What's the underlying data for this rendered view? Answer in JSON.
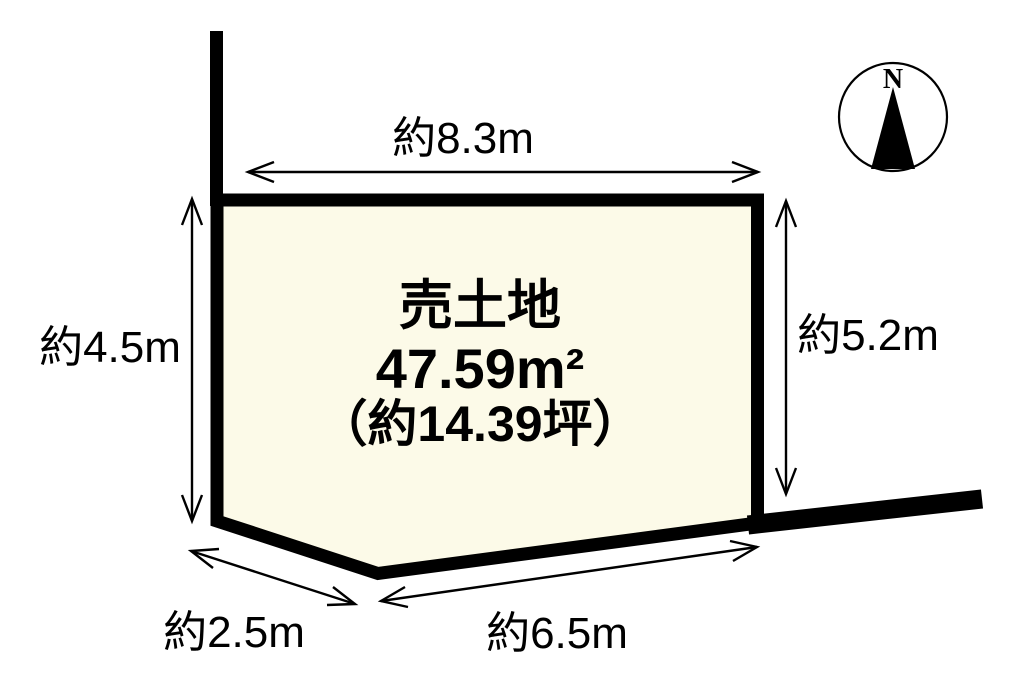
{
  "canvas": {
    "background": "#FFFFFF"
  },
  "parcel": {
    "title": "売土地",
    "area_m2": "47.59m²",
    "area_tsubo": "（約14.39坪）",
    "fill_color": "#FCFAE8",
    "outline_color": "#000000"
  },
  "dimensions": {
    "top": "約8.3m",
    "left": "約4.5m",
    "right": "約5.2m",
    "bottom_left": "約2.5m",
    "bottom": "約6.5m"
  },
  "compass": {
    "north_label": "N"
  }
}
